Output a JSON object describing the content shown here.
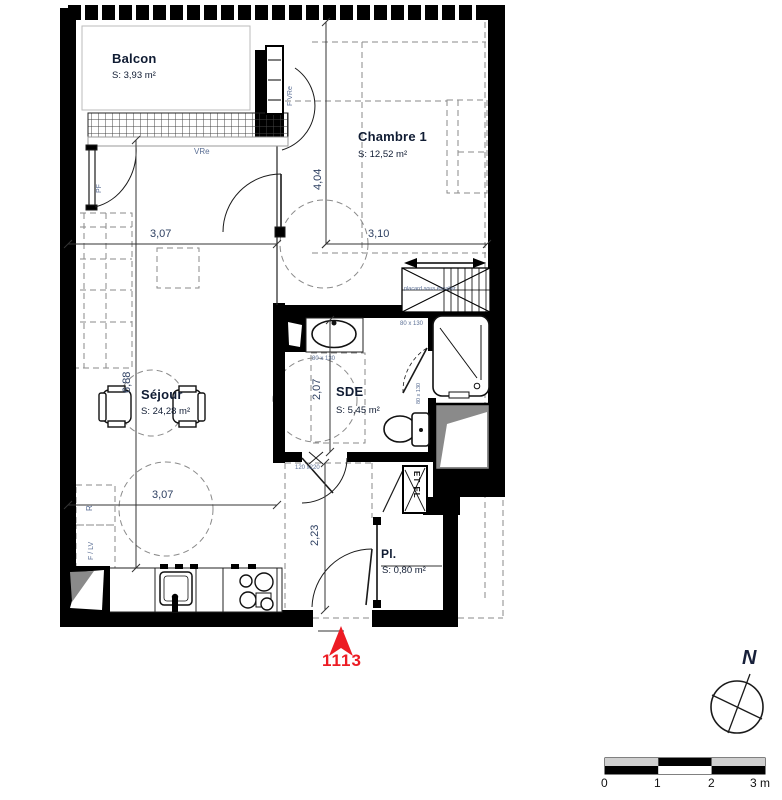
{
  "plan": {
    "unit": {
      "number": "1113"
    },
    "rooms": {
      "balcon": {
        "name": "Balcon",
        "area": "S: 3,93 m²"
      },
      "chambre": {
        "name": "Chambre 1",
        "area": "S: 12,52 m²"
      },
      "sejour": {
        "name": "Séjour",
        "area": "S: 24,28 m²"
      },
      "sde": {
        "name": "SDE",
        "area": "S: 5,45 m²"
      },
      "placard": {
        "name": "Pl.",
        "area": "S: 0,80 m²"
      }
    },
    "dims": {
      "top_left": "3,07",
      "top_right": "3,10",
      "chambre_v": "4,04",
      "sejour_v": "6,88",
      "bottom": "3,07",
      "sde_v": "2,07",
      "hall_v": "2,23"
    },
    "tags": {
      "vre": "VRe",
      "pf": "PF",
      "f_vre": "F VRe",
      "f_lv": "F / LV",
      "r": "R",
      "s80a": "80 x 130",
      "s80b": "80 x 130",
      "s80c": "80 x 130",
      "s120": "120 x220",
      "under_stairs": "placard sous escalier",
      "etel": "ET EL"
    },
    "compass": {
      "label": "N"
    },
    "scale": {
      "t0": "0",
      "t1": "1",
      "t2": "2",
      "t3": "3 m"
    },
    "colors": {
      "red": "#ec1b23",
      "navy": "#101c33",
      "blue": "#5a6e94"
    }
  }
}
